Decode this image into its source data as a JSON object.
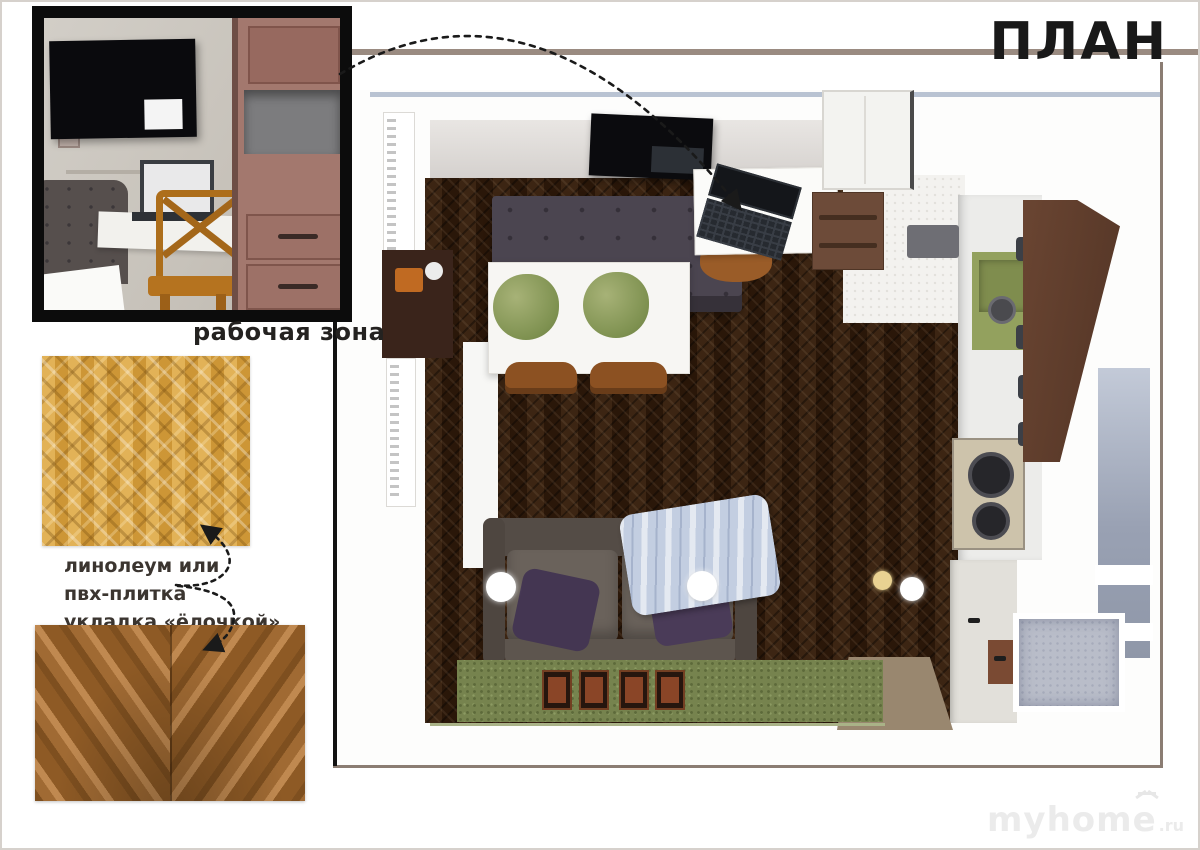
{
  "header": {
    "title": "ПЛАН"
  },
  "workspace_photo": {
    "caption": "рабочая зона"
  },
  "flooring_note": {
    "line1": "линолеум или",
    "line2": "пвх-плитка",
    "line3": "укладка «ёлочкой»"
  },
  "watermark": {
    "brand": "myhome",
    "tld": ".ru"
  },
  "icons": {
    "photo_to_plan_arrow": "dotted-arrow",
    "note_to_samples_arrow": "dotted-arrow",
    "watermark_house": "house-icon"
  },
  "colors": {
    "frame_line": "#9a8b81",
    "photo_frame": "#0c0c0c",
    "sample_gold": "#dca849",
    "sample_walnut": "#a06a33",
    "plan_floor_dark": "#31200f",
    "rug_green": "#76834e",
    "sofa_gray": "#6a625b",
    "sink_olive": "#93a15e",
    "balcony_blue": "#99a1b3"
  }
}
